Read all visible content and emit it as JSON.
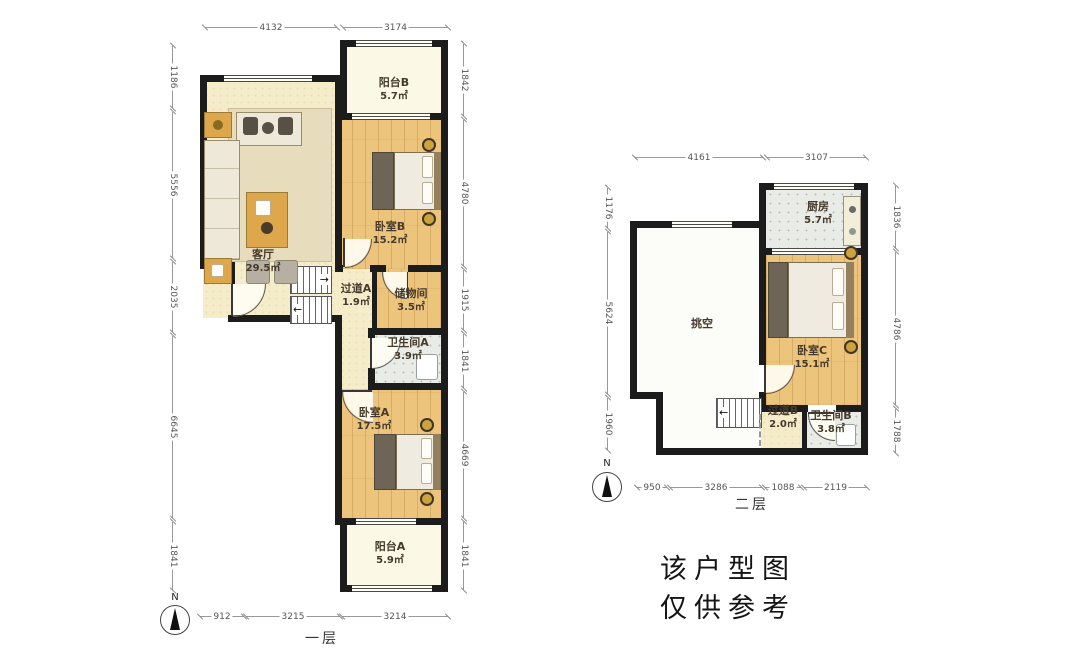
{
  "floor1": {
    "title": "一层",
    "compass": "N",
    "rooms": {
      "balcony_b": {
        "name": "阳台B",
        "area": "5.7㎡"
      },
      "bedroom_b": {
        "name": "卧室B",
        "area": "15.2㎡"
      },
      "living": {
        "name": "客厅",
        "area": "29.5㎡"
      },
      "hallway_a": {
        "name": "过道A",
        "area": "1.9㎡"
      },
      "storage": {
        "name": "储物间",
        "area": "3.5㎡"
      },
      "bath_a": {
        "name": "卫生间A",
        "area": "3.9㎡"
      },
      "bedroom_a": {
        "name": "卧室A",
        "area": "17.5㎡"
      },
      "balcony_a": {
        "name": "阳台A",
        "area": "5.9㎡"
      }
    },
    "dims": {
      "top": [
        "4132",
        "3174"
      ],
      "left": [
        "1186",
        "5556",
        "2035",
        "6645",
        "1841"
      ],
      "right": [
        "1842",
        "4780",
        "1915",
        "1841",
        "4669",
        "1841"
      ],
      "bottom": [
        "912",
        "3215",
        "3214"
      ]
    }
  },
  "floor2": {
    "title": "二层",
    "compass": "N",
    "rooms": {
      "kitchen": {
        "name": "厨房",
        "area": "5.7㎡"
      },
      "void": {
        "name": "挑空",
        "area": ""
      },
      "bedroom_c": {
        "name": "卧室C",
        "area": "15.1㎡"
      },
      "hallway_b": {
        "name": "过道B",
        "area": "2.0㎡"
      },
      "bath_b": {
        "name": "卫生间B",
        "area": "3.8㎡"
      }
    },
    "dims": {
      "top": [
        "4161",
        "3107"
      ],
      "left": [
        "1176",
        "5624",
        "1960"
      ],
      "right": [
        "1836",
        "4786",
        "1788"
      ],
      "bottom": [
        "950",
        "3286",
        "1088",
        "2119"
      ]
    }
  },
  "note": {
    "line1": "该户型图",
    "line2": "仅供参考"
  },
  "icons": {
    "stair_arrow_right": "→",
    "stair_arrow_left": "←"
  },
  "palette": {
    "wall": "#1c1c1c",
    "wood_floor": "#ecc47c",
    "pale_floor": "#f5ecc9",
    "balcony_floor": "#fbf8e6",
    "tile_floor": "#e9ebe7",
    "void_floor": "#fcfcf9",
    "dim_line": "#999999"
  }
}
